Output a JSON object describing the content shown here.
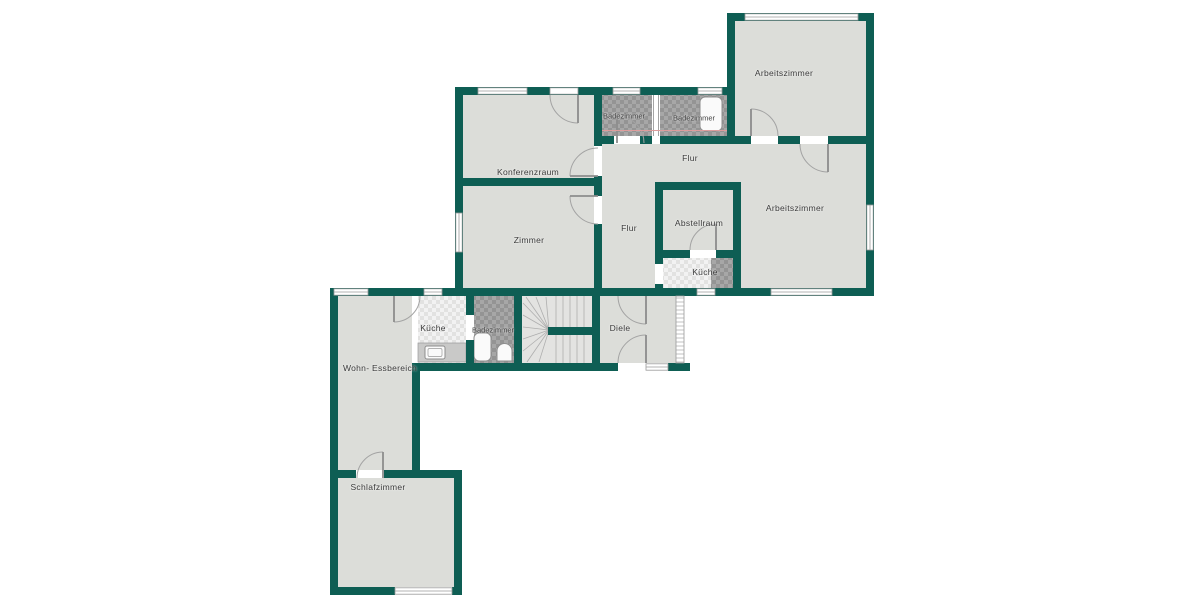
{
  "plan": {
    "colors": {
      "wall": "#0e5e54",
      "floor": "#dcddd9",
      "stairs_floor": "#e3e3e1",
      "tile_dark_a": "#a7a7a7",
      "tile_dark_b": "#949494",
      "tile_light_a": "#f2f2f2",
      "tile_light_b": "#e2e2e1",
      "section_line": "#dd9c9c",
      "line": "#9a9a9a"
    },
    "rooms": [
      {
        "id": "arbeitszimmer-top",
        "label": "Arbeitszimmer"
      },
      {
        "id": "badezimmer-top-left",
        "label": "Badezimmer"
      },
      {
        "id": "badezimmer-top-right",
        "label": "Badezimmer"
      },
      {
        "id": "flur-upper",
        "label": "Flur"
      },
      {
        "id": "konferenzraum",
        "label": "Konferenzraum"
      },
      {
        "id": "arbeitszimmer-right",
        "label": "Arbeitszimmer"
      },
      {
        "id": "abstellraum",
        "label": "Abstellraum"
      },
      {
        "id": "flur-center",
        "label": "Flur"
      },
      {
        "id": "zimmer",
        "label": "Zimmer"
      },
      {
        "id": "kueche-upper",
        "label": "Küche"
      },
      {
        "id": "kueche-lower",
        "label": "Küche"
      },
      {
        "id": "badezimmer-lower",
        "label": "Badezimmer"
      },
      {
        "id": "diele",
        "label": "Diele"
      },
      {
        "id": "wohn-essbereich",
        "label": "Wohn- Essbereich"
      },
      {
        "id": "schlafzimmer",
        "label": "Schlafzimmer"
      }
    ]
  }
}
